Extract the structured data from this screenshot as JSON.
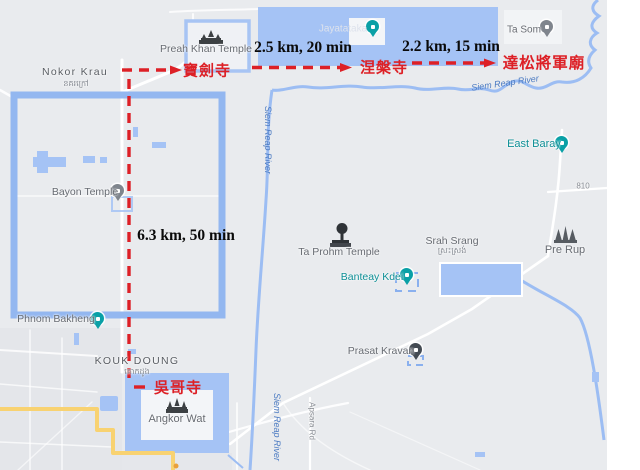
{
  "title": "Angkor temples tuk-tuk route map (Google Maps with annotated route)",
  "colors": {
    "map_background": "#e9ebee",
    "water_blue": "#a5c3f5",
    "river_blue": "#9cbdf3",
    "road_yellow": "#f8d271",
    "route_red": "#dd2026",
    "poi_teal": "#0aa0a6",
    "pin_gray": "#7f858d",
    "pin_dark": "#434a52",
    "water_label_blue": "#4c7bc2",
    "annotation_black": "#0a0a0a"
  },
  "route": {
    "segments": [
      {
        "from": "Preah Khan",
        "to": "Neak Pean",
        "distance_label": "2.5 km, 20 min"
      },
      {
        "from": "Neak Pean",
        "to": "Ta Som",
        "distance_label": "2.2 km, 15 min"
      },
      {
        "from": "Preah Khan",
        "to": "Angkor Wat",
        "distance_label": "6.3 km, 50 min"
      }
    ],
    "stops": {
      "preah_khan_cn": "寶劍寺",
      "neak_pean_cn": "涅槃寺",
      "ta_som_cn": "達松將軍廟",
      "angkor_wat_cn": "吳哥寺"
    }
  },
  "map_labels": {
    "preah_khan": "Preah Khan Temple",
    "nokor_krau": "Nokor Krau",
    "nokor_krau_khmer": "នគរក្រៅ",
    "bayon": "Bayon Temple",
    "phnom_bakheng": "Phnom Bakheng",
    "kouk_doung": "KOUK DOUNG",
    "kouk_doung_khmer": "គោកដូង",
    "angkor_wat": "Angkor Wat",
    "ta_prohm": "Ta Prohm Temple",
    "banteay_kdei": "Banteay Kdei",
    "srah_srang": "Srah Srang",
    "srah_srang_khmer": "ស្រះស្រង់",
    "pre_rup": "Pre Rup",
    "east_baray": "East Baray",
    "ta_som": "Ta Som",
    "prasat_kravan": "Prasat Kravan",
    "jayatataka": "Jayatataka",
    "siem_reap_river": "Siem Reap River",
    "road_810": "810",
    "apsara_rd": "Apsara Rd"
  }
}
